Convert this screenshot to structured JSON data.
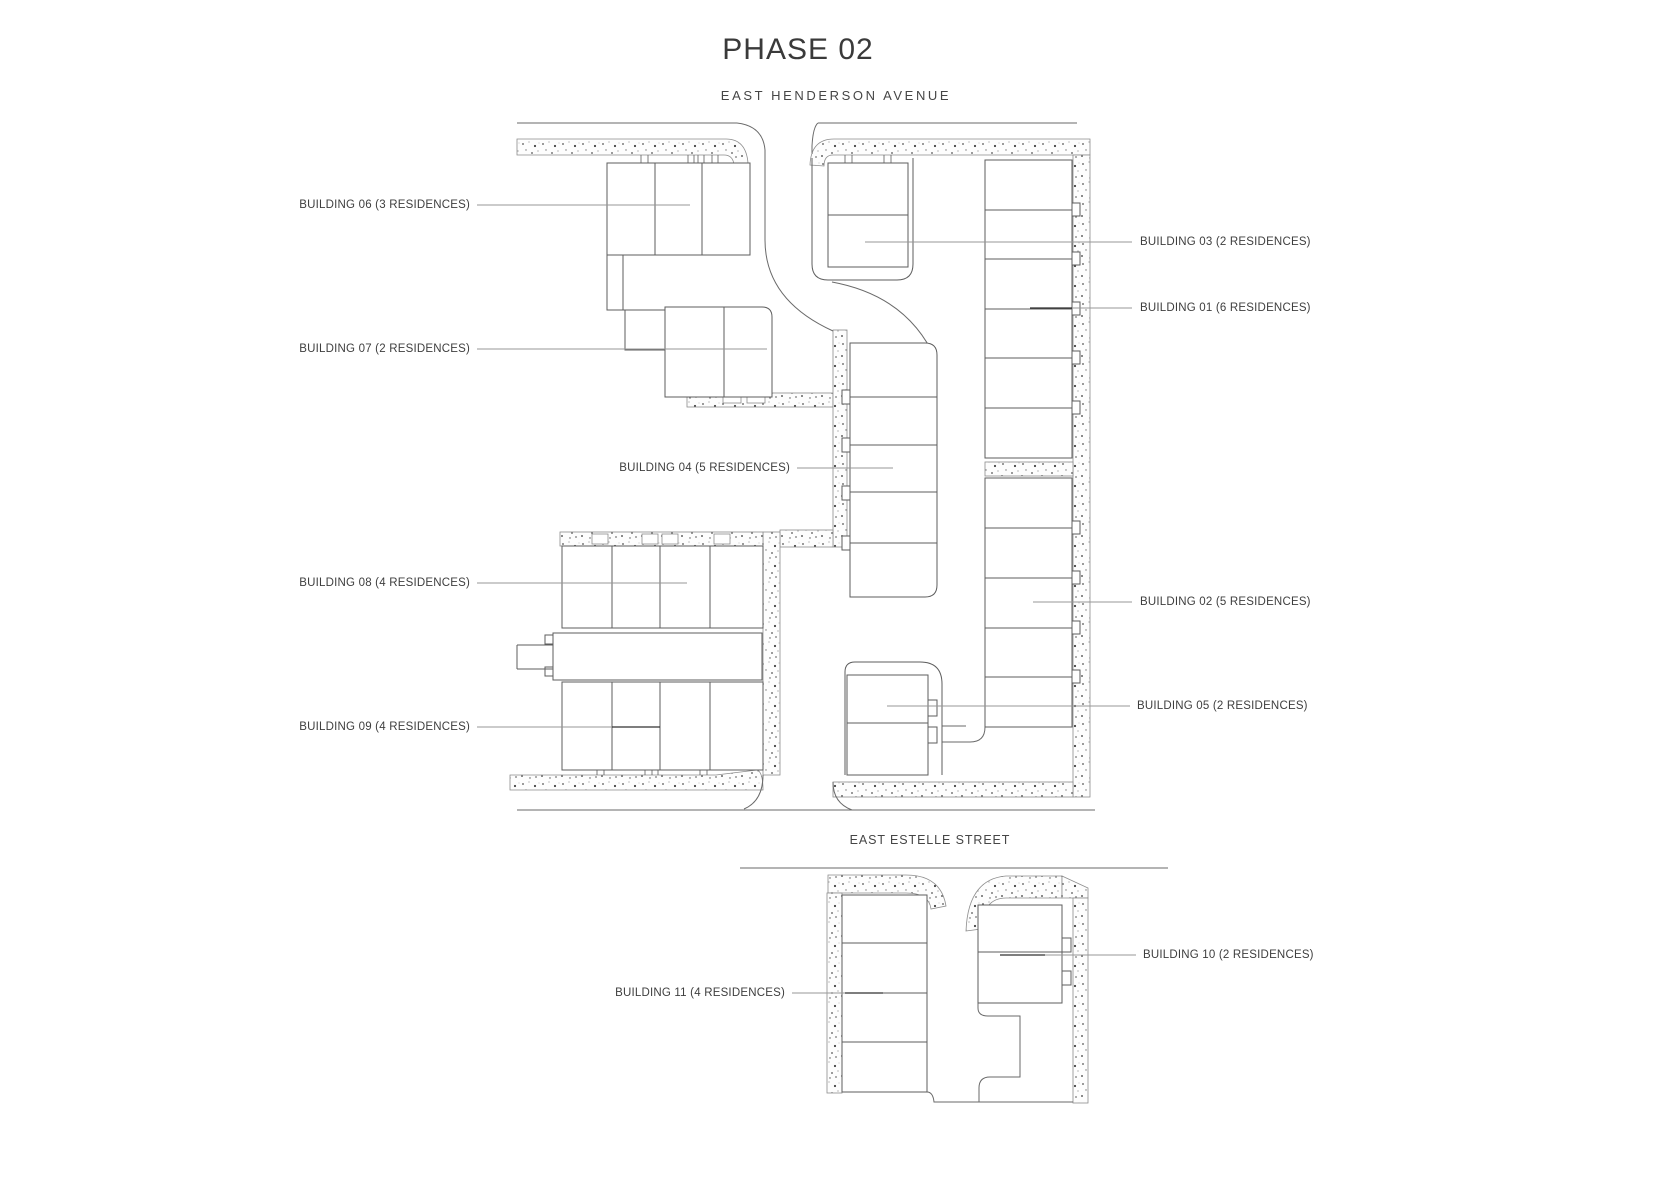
{
  "title": "PHASE 02",
  "streets": {
    "north": "EAST HENDERSON AVENUE",
    "south": "EAST ESTELLE STREET"
  },
  "buildings": [
    {
      "id": "01",
      "label": "BUILDING 01 (6 RESIDENCES)",
      "residences": 6
    },
    {
      "id": "02",
      "label": "BUILDING 02 (5 RESIDENCES)",
      "residences": 5
    },
    {
      "id": "03",
      "label": "BUILDING 03 (2 RESIDENCES)",
      "residences": 2
    },
    {
      "id": "04",
      "label": "BUILDING 04 (5 RESIDENCES)",
      "residences": 5
    },
    {
      "id": "05",
      "label": "BUILDING 05 (2 RESIDENCES)",
      "residences": 2
    },
    {
      "id": "06",
      "label": "BUILDING 06 (3 RESIDENCES)",
      "residences": 3
    },
    {
      "id": "07",
      "label": "BUILDING 07 (2 RESIDENCES)",
      "residences": 2
    },
    {
      "id": "08",
      "label": "BUILDING 08 (4 RESIDENCES)",
      "residences": 4
    },
    {
      "id": "09",
      "label": "BUILDING 09 (4 RESIDENCES)",
      "residences": 4
    },
    {
      "id": "10",
      "label": "BUILDING 10 (2 RESIDENCES)",
      "residences": 2
    },
    {
      "id": "11",
      "label": "BUILDING 11 (4 RESIDENCES)",
      "residences": 4
    }
  ]
}
